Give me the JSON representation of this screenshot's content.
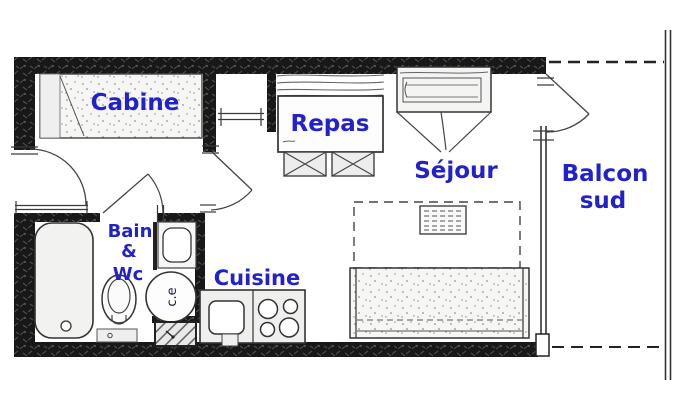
{
  "plan": {
    "type": "floor-plan",
    "rooms": {
      "cabine": {
        "label": "Cabine"
      },
      "repas": {
        "label": "Repas"
      },
      "sejour": {
        "label": "Séjour"
      },
      "balcon": {
        "label_line1": "Balcon",
        "label_line2": "sud"
      },
      "cuisine": {
        "label": "Cuisine"
      },
      "bain": {
        "label_line1": "Bain",
        "label_line2": "&",
        "label_line3": "Wc"
      }
    },
    "fixtures": {
      "water_heater_label": "c.e"
    },
    "colors": {
      "label_blue": "#2222cc",
      "wall_black": "#181818",
      "line_gray": "#333333",
      "fill_light": "#f2f2f1"
    }
  }
}
